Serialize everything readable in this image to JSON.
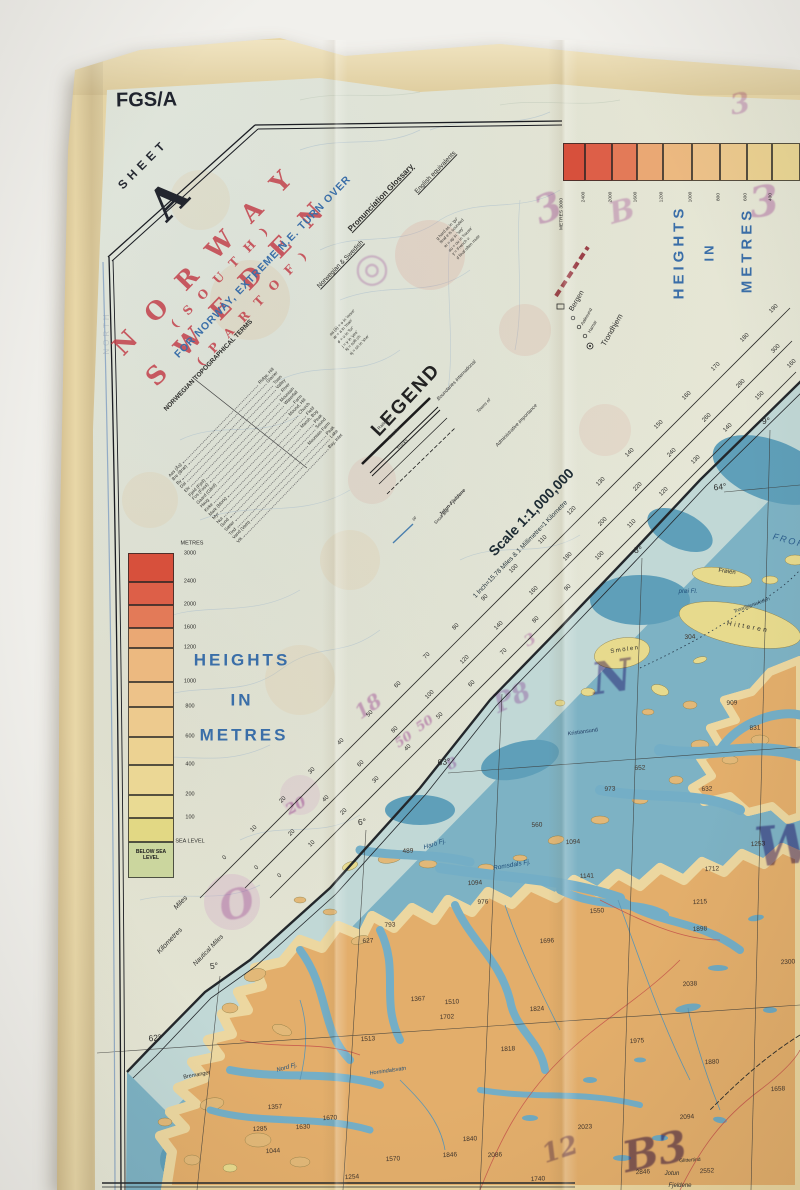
{
  "header": {
    "series": "FGS/A",
    "sheet_word": "SHEET",
    "sheet_letter": "A"
  },
  "title": {
    "line1": "N O R W A Y",
    "line2": "( S O U T H )",
    "line3": "S W E D E N",
    "line4": "( P A R T  O F )"
  },
  "turn_over_note": "FOR NORWAY, EXTREME N.E. TURN OVER",
  "legend": {
    "heading": "LEGEND"
  },
  "scale": {
    "text": "Scale 1:1,000,000",
    "sub": "1 Inch=15.78 Miles & 1 Millimetre=1 Kilometre"
  },
  "heights_words": [
    "HEIGHTS",
    "IN",
    "METRES"
  ],
  "colors": {
    "title_red": "#c23b46",
    "map_blue": "#3a6ea8",
    "sea": "#7db2c4",
    "sea_deep": "#5f9fb9",
    "sea_shallow": "#c9dcd8",
    "land": "#e3ae6b",
    "land_light": "#ecd7a0",
    "island_yellow": "#e7da8d",
    "highland": "#dd8050",
    "highland_high": "#d9663c",
    "glacier": "#f2efe4",
    "fabric": "#e8d7a8",
    "print_bg": "#e7e9da",
    "annotation_magenta": "#b14fb0",
    "annotation_violet": "#46288f"
  },
  "heights_left": {
    "x": 128,
    "w": 46,
    "top": 553,
    "unit": "METRES",
    "top_label": "3000",
    "bands": [
      {
        "to": "2400",
        "y": 553,
        "h": 29,
        "color": "#d7503c"
      },
      {
        "to": "2000",
        "y": 582,
        "h": 23,
        "color": "#dd5f48"
      },
      {
        "to": "1600",
        "y": 605,
        "h": 23,
        "color": "#e37a58"
      },
      {
        "to": "1200",
        "y": 628,
        "h": 20,
        "color": "#eaa874"
      },
      {
        "to": "1000",
        "y": 648,
        "h": 34,
        "color": "#ecb980"
      },
      {
        "to": "800",
        "y": 682,
        "h": 25,
        "color": "#edc289"
      },
      {
        "to": "600",
        "y": 707,
        "h": 30,
        "color": "#edca8e"
      },
      {
        "to": "400",
        "y": 737,
        "h": 28,
        "color": "#ecd292"
      },
      {
        "to": "200",
        "y": 765,
        "h": 30,
        "color": "#ebd795"
      },
      {
        "to": "100",
        "y": 795,
        "h": 23,
        "color": "#e9da93"
      },
      {
        "to": "SEA LEVEL",
        "y": 818,
        "h": 24,
        "color": "#e2d884"
      },
      {
        "to": "",
        "y": 842,
        "h": 36,
        "color": "#cbd69e",
        "inside": "BELOW SEA LEVEL"
      }
    ]
  },
  "heights_top": {
    "y": 143,
    "h": 38,
    "segments": [
      {
        "x": 563,
        "w": 22,
        "c": "#d7503c",
        "l": "METRES 3000"
      },
      {
        "x": 585,
        "w": 27,
        "c": "#dd5f48",
        "l": "2400"
      },
      {
        "x": 612,
        "w": 25,
        "c": "#e37a58",
        "l": "2000"
      },
      {
        "x": 637,
        "w": 26,
        "c": "#eaa874",
        "l": "1600"
      },
      {
        "x": 663,
        "w": 29,
        "c": "#ecb980",
        "l": "1200"
      },
      {
        "x": 692,
        "w": 28,
        "c": "#edc289",
        "l": "1000"
      },
      {
        "x": 720,
        "w": 27,
        "c": "#edca8e",
        "l": "800"
      },
      {
        "x": 747,
        "w": 25,
        "c": "#ecd292",
        "l": "600"
      },
      {
        "x": 772,
        "w": 28,
        "c": "#ebd795",
        "l": "400"
      }
    ]
  },
  "rulers": [
    {
      "id": "miles",
      "x0": 225,
      "y0": 858,
      "step": 28.9,
      "values": [
        0,
        10,
        20,
        30,
        40,
        50,
        60,
        70,
        80,
        90,
        100,
        110,
        120,
        130,
        140,
        150,
        160,
        170,
        180,
        190
      ]
    },
    {
      "id": "kilometres",
      "x0": 257,
      "y0": 868,
      "step": 34.6,
      "values": [
        0,
        20,
        40,
        60,
        80,
        100,
        120,
        140,
        160,
        180,
        200,
        220,
        240,
        260,
        280,
        300
      ]
    },
    {
      "id": "nautical-miles",
      "x0": 280,
      "y0": 876,
      "step": 32,
      "values": [
        0,
        10,
        20,
        30,
        40,
        50,
        60,
        70,
        80,
        90,
        100,
        110,
        120,
        130,
        140,
        150,
        160,
        170,
        180
      ]
    }
  ],
  "terms": {
    "pairs": [
      [
        "Aas (Ås)",
        "Ridge, Hill"
      ],
      [
        "Bre (Bræ)",
        "Glacier"
      ],
      [
        "By",
        "Town"
      ],
      [
        "Dal",
        "Valley"
      ],
      [
        "Elv",
        "River"
      ],
      [
        "Fjeld (Fjell)",
        "Mountain"
      ],
      [
        "Fos (Foss)",
        "Waterfall"
      ],
      [
        "Gaard (Gård)",
        "Farm"
      ],
      [
        "Haug",
        "Mound, Hill"
      ],
      [
        "Kirke",
        "Church"
      ],
      [
        "Mark (Mork)",
        "Field"
      ],
      [
        "Myr",
        "Marsh, Bog"
      ],
      [
        "Nut",
        "Peak"
      ],
      [
        "Sund",
        "Sound"
      ],
      [
        "Sæter",
        "Mountain Farm"
      ],
      [
        "Tind",
        "Peak"
      ],
      [
        "Vand (Vatn)",
        "Lake"
      ],
      [
        "Vik",
        "Bay, Inlet"
      ]
    ]
  },
  "glossary": {
    "rows1": [
      "aa (å) = o in 'more'",
      "æ = a in 'man'",
      "ø = u in 'fur'",
      "j = y in 'yes'",
      "kj = soft ch",
      "sj = sh in 'she'"
    ],
    "rows2": [
      "g hard as in 'go'",
      "final e is sounded",
      "ei = ay in 'say'",
      "au = ou in 'house'",
      "y = French u",
      "d final often mute"
    ]
  },
  "labels": [
    {
      "t": "FOR NORWAY, EXTREME N.E. TURN OVER",
      "x": 263,
      "y": 267,
      "r": -46,
      "s": 10.5,
      "c": "#3a6ea8",
      "ls": 1,
      "w": "bold",
      "n": "turn-over-note"
    },
    {
      "t": "NORWEGIAN TOPOGRAPHICAL TERMS",
      "x": 209,
      "y": 366,
      "r": -46,
      "s": 6.5,
      "w": "bold",
      "c": "#2d2d2b",
      "n": "terms-heading"
    },
    {
      "t": "Pronunciation Glossary",
      "x": 381,
      "y": 198,
      "r": -46,
      "s": 8,
      "w": "bold",
      "u": 1,
      "c": "#2d2d2b",
      "n": "glossary-heading"
    },
    {
      "t": "Norwegian & Swedish",
      "x": 341,
      "y": 265,
      "r": -46,
      "s": 6.5,
      "u": 1,
      "c": "#2d2d2b",
      "n": "glossary-col1"
    },
    {
      "t": "English equivalents",
      "x": 436,
      "y": 173,
      "r": -46,
      "s": 6.5,
      "u": 1,
      "c": "#2d2d2b",
      "n": "glossary-col2"
    },
    {
      "t": "Scale 1:1,000,000",
      "x": 531,
      "y": 512,
      "r": -46,
      "s": 14,
      "w": "bold",
      "c": "#1d2b33",
      "n": "scale-text"
    },
    {
      "t": "1 Inch=15.78 Miles & 1 Millimetre=1 Kilometre",
      "x": 521,
      "y": 550,
      "r": -46,
      "s": 6.5,
      "c": "#26343c",
      "n": "scale-subtext"
    },
    {
      "t": "Miles",
      "x": 181,
      "y": 903,
      "r": -46,
      "s": 7,
      "i": 1,
      "c": "#2d2d2b",
      "n": "ruler-label"
    },
    {
      "t": "Kilometres",
      "x": 170,
      "y": 941,
      "r": -46,
      "s": 7,
      "i": 1,
      "c": "#2d2d2b",
      "n": "ruler-label"
    },
    {
      "t": "Nautical Miles",
      "x": 209,
      "y": 951,
      "r": -46,
      "s": 6.5,
      "i": 1,
      "c": "#2d2d2b",
      "n": "ruler-label"
    },
    {
      "t": "Railways",
      "x": 385,
      "y": 423,
      "r": -46,
      "s": 4.5,
      "c": "#333333",
      "n": "legend-item"
    },
    {
      "t": "Roads",
      "x": 394,
      "y": 434,
      "r": -46,
      "s": 4.5,
      "c": "#333333",
      "n": "legend-item"
    },
    {
      "t": "Tracks",
      "x": 403,
      "y": 445,
      "r": -46,
      "s": 4.5,
      "c": "#333333",
      "n": "legend-item"
    },
    {
      "t": "Boundaries international",
      "x": 457,
      "y": 381,
      "r": -46,
      "s": 5,
      "i": 1,
      "c": "#333333",
      "n": "legend-item"
    },
    {
      "t": "Towns of",
      "x": 484,
      "y": 406,
      "r": -46,
      "s": 4.5,
      "i": 1,
      "c": "#333333",
      "n": "legend-item"
    },
    {
      "t": "Administrative importance",
      "x": 517,
      "y": 426,
      "r": -46,
      "s": 5,
      "i": 1,
      "c": "#333333",
      "n": "legend-item"
    },
    {
      "t": "Jotun-Fjeldene",
      "x": 453,
      "y": 503,
      "r": -46,
      "s": 5,
      "w": "bold",
      "i": 1,
      "c": "#333333",
      "n": "legend-item"
    },
    {
      "t": "Snow line",
      "x": 442,
      "y": 517,
      "r": -46,
      "s": 4.5,
      "i": 1,
      "c": "#333333",
      "n": "legend-item"
    },
    {
      "t": "or",
      "x": 415,
      "y": 519,
      "r": -46,
      "s": 5,
      "i": 1,
      "c": "#333333",
      "n": "legend-item"
    },
    {
      "t": "Bergen",
      "x": 577,
      "y": 301,
      "r": -60,
      "s": 7,
      "c": "#2d2d2b",
      "n": "legend-town"
    },
    {
      "t": "Aalesund",
      "x": 587,
      "y": 317,
      "r": -60,
      "s": 4.5,
      "c": "#2d2d2b",
      "n": "legend-town"
    },
    {
      "t": "Hamar",
      "x": 593,
      "y": 327,
      "r": -60,
      "s": 4.5,
      "c": "#2d2d2b",
      "n": "legend-town"
    },
    {
      "t": "Trondhjem",
      "x": 612,
      "y": 330,
      "r": -60,
      "s": 7.5,
      "c": "#2d2d2b",
      "n": "legend-town"
    },
    {
      "t": "5°",
      "x": 214,
      "y": 966,
      "r": -6,
      "s": 8.5,
      "c": "#2d2d2b",
      "n": "graticule-label"
    },
    {
      "t": "6°",
      "x": 362,
      "y": 822,
      "r": -6,
      "s": 8.5,
      "c": "#2d2d2b",
      "n": "graticule-label"
    },
    {
      "t": "8°",
      "x": 638,
      "y": 550,
      "r": -6,
      "s": 8.5,
      "c": "#2d2d2b",
      "n": "graticule-label"
    },
    {
      "t": "9°",
      "x": 766,
      "y": 421,
      "r": -6,
      "s": 8.5,
      "c": "#2d2d2b",
      "n": "graticule-label"
    },
    {
      "t": "64°",
      "x": 720,
      "y": 487,
      "r": -6,
      "s": 8.5,
      "c": "#2d2d2b",
      "n": "graticule-label"
    },
    {
      "t": "63°",
      "x": 444,
      "y": 762,
      "r": -6,
      "s": 8.5,
      "c": "#2d2d2b",
      "n": "graticule-label"
    },
    {
      "t": "62°",
      "x": 155,
      "y": 1038,
      "r": -6,
      "s": 8.5,
      "c": "#2d2d2b",
      "n": "graticule-label"
    },
    {
      "t": "Harö Fj.",
      "x": 435,
      "y": 845,
      "r": -18,
      "s": 6.5,
      "c": "#1f4e79",
      "i": 1,
      "n": "place-name"
    },
    {
      "t": "Romsdals Fj.",
      "x": 512,
      "y": 866,
      "r": -10,
      "s": 6.5,
      "c": "#1f4e79",
      "i": 1,
      "n": "place-name"
    },
    {
      "t": "FROHAVET",
      "x": 804,
      "y": 545,
      "r": 15,
      "s": 9,
      "c": "#2b5d8c",
      "i": 1,
      "ls": 2,
      "n": "place-name"
    },
    {
      "t": "Frøien",
      "x": 727,
      "y": 572,
      "r": 8,
      "s": 6,
      "c": "#2d2d2b",
      "n": "place-name"
    },
    {
      "t": "Hitteren",
      "x": 748,
      "y": 628,
      "r": 10,
      "s": 6.5,
      "ls": 2.5,
      "c": "#2d2d2b",
      "n": "place-name"
    },
    {
      "t": "Smölen",
      "x": 625,
      "y": 650,
      "r": -8,
      "s": 6,
      "ls": 1.5,
      "c": "#2d2d2b",
      "n": "place-name"
    },
    {
      "t": "prøi Fl.",
      "x": 688,
      "y": 592,
      "s": 6,
      "i": 1,
      "c": "#1f4e79",
      "n": "place-name"
    },
    {
      "t": "Trondhjemsleden",
      "x": 752,
      "y": 606,
      "r": -20,
      "s": 5,
      "i": 1,
      "c": "#2c3e50",
      "n": "place-name"
    },
    {
      "t": "Kristiansund",
      "x": 583,
      "y": 733,
      "r": -8,
      "s": 5.5,
      "c": "#203a60",
      "n": "place-name"
    },
    {
      "t": "Hornindalsvatn",
      "x": 388,
      "y": 1072,
      "r": -8,
      "s": 5.5,
      "c": "#1f4e79",
      "i": 1,
      "n": "place-name"
    },
    {
      "t": "Bremanger",
      "x": 197,
      "y": 1076,
      "r": -10,
      "s": 5.5,
      "c": "#2d2d2b",
      "n": "place-name"
    },
    {
      "t": "Nord Fj.",
      "x": 287,
      "y": 1068,
      "r": -15,
      "s": 6,
      "c": "#1f4e79",
      "i": 1,
      "n": "place-name"
    },
    {
      "t": "Glittertind",
      "x": 690,
      "y": 1161,
      "r": -4,
      "s": 5,
      "c": "#2d2d2b",
      "n": "place-name"
    },
    {
      "t": "Jotun",
      "x": 672,
      "y": 1174,
      "s": 6,
      "i": 1,
      "c": "#2d2d2b",
      "n": "place-name"
    },
    {
      "t": "Fjeldene",
      "x": 680,
      "y": 1186,
      "s": 6,
      "i": 1,
      "c": "#2d2d2b",
      "n": "place-name"
    },
    {
      "t": "NORTH",
      "x": 107,
      "y": 333,
      "r": -90,
      "s": 8,
      "c": "#8791a5",
      "o": 0.35,
      "ls": 3,
      "n": "showthrough-text"
    }
  ],
  "spot_heights": [
    [
      489,
      408,
      852
    ],
    [
      1094,
      475,
      884
    ],
    [
      976,
      483,
      903
    ],
    [
      793,
      390,
      926
    ],
    [
      627,
      368,
      942
    ],
    [
      1696,
      547,
      942
    ],
    [
      1550,
      597,
      912
    ],
    [
      1367,
      418,
      1000
    ],
    [
      1510,
      452,
      1003
    ],
    [
      1702,
      447,
      1018
    ],
    [
      1824,
      537,
      1010
    ],
    [
      1513,
      368,
      1040
    ],
    [
      1818,
      508,
      1050
    ],
    [
      1141,
      587,
      877
    ],
    [
      1094,
      573,
      843
    ],
    [
      560,
      537,
      826
    ],
    [
      304,
      690,
      638
    ],
    [
      909,
      732,
      704
    ],
    [
      831,
      755,
      729
    ],
    [
      652,
      640,
      769
    ],
    [
      632,
      707,
      790
    ],
    [
      973,
      610,
      790
    ],
    [
      1215,
      700,
      903
    ],
    [
      1712,
      712,
      870
    ],
    [
      1253,
      758,
      845
    ],
    [
      1898,
      700,
      930
    ],
    [
      2038,
      690,
      985
    ],
    [
      2300,
      788,
      963
    ],
    [
      1975,
      637,
      1042
    ],
    [
      1880,
      712,
      1063
    ],
    [
      1658,
      778,
      1090
    ],
    [
      2094,
      687,
      1118
    ],
    [
      2023,
      585,
      1128
    ],
    [
      2552,
      707,
      1172
    ],
    [
      2846,
      643,
      1173
    ],
    [
      2086,
      495,
      1156
    ],
    [
      1840,
      470,
      1140
    ],
    [
      1846,
      450,
      1156
    ],
    [
      1740,
      538,
      1180
    ],
    [
      1357,
      275,
      1108
    ],
    [
      1670,
      330,
      1119
    ],
    [
      1285,
      260,
      1130
    ],
    [
      1630,
      303,
      1128
    ],
    [
      1044,
      273,
      1152
    ],
    [
      1570,
      393,
      1160
    ],
    [
      1254,
      352,
      1178
    ]
  ],
  "annotations": [
    [
      "◎",
      372,
      268,
      0,
      40,
      "#b14fb0",
      0.3
    ],
    [
      "3",
      548,
      208,
      -20,
      38,
      "#b14fb0",
      0.4
    ],
    [
      "B",
      622,
      212,
      -15,
      30,
      "#b14fb0",
      0.35
    ],
    [
      "3",
      764,
      202,
      -8,
      42,
      "#b14fb0",
      0.4
    ],
    [
      "3",
      740,
      104,
      -10,
      28,
      "#b14fb0",
      0.35
    ],
    [
      "18",
      368,
      706,
      -35,
      20,
      "#b14fb0",
      0.45
    ],
    [
      "50",
      404,
      740,
      -35,
      13,
      "#b14fb0",
      0.5
    ],
    [
      "50",
      425,
      724,
      -35,
      13,
      "#b14fb0",
      0.5
    ],
    [
      "P8",
      512,
      698,
      -25,
      26,
      "#b14fb0",
      0.38
    ],
    [
      "20",
      296,
      806,
      -30,
      15,
      "#b14fb0",
      0.5
    ],
    [
      "O",
      237,
      905,
      -15,
      40,
      "#b14fb0",
      0.35
    ],
    [
      "8",
      452,
      764,
      -25,
      15,
      "#b14fb0",
      0.45
    ],
    [
      "3",
      530,
      640,
      -30,
      16,
      "#b14fb0",
      0.4
    ],
    [
      "N",
      612,
      678,
      -8,
      44,
      "#46288f",
      0.5
    ],
    [
      "W",
      785,
      845,
      -5,
      54,
      "#46288f",
      0.55
    ],
    [
      "B3",
      655,
      1152,
      -12,
      42,
      "#46288f",
      0.6
    ],
    [
      "12",
      560,
      1150,
      -18,
      26,
      "#5a3a9a",
      0.45
    ]
  ]
}
